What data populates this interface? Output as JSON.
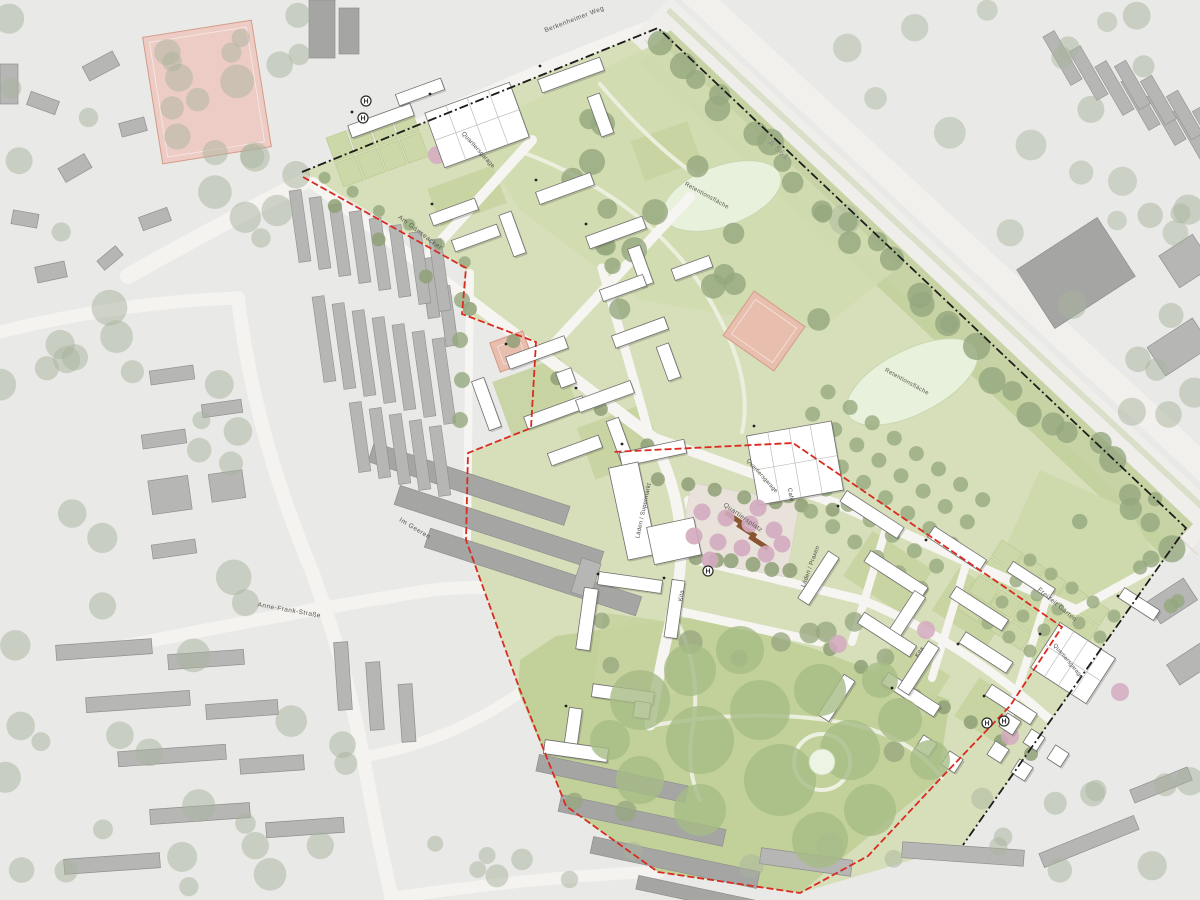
{
  "plan": {
    "labels": [
      {
        "id": "street-berkenheimer-weg",
        "text": "Berkenheimer Weg",
        "x": 575,
        "y": 21,
        "rot": -21,
        "size": 6.5,
        "color": "#55564f",
        "ls": 0.5
      },
      {
        "id": "highway-a561",
        "text": "A 561",
        "x": 777,
        "y": 152,
        "rot": 43,
        "size": 8,
        "color": "#8f9089",
        "ls": 1
      },
      {
        "id": "quartiersgarage-north",
        "text": "Quartiersgarage",
        "x": 477,
        "y": 151,
        "rot": 48,
        "size": 6,
        "color": "#4a4a44",
        "ls": 0.2
      },
      {
        "id": "retentionsflaeche-north",
        "text": "Retentionsfläche",
        "x": 706,
        "y": 197,
        "rot": 29,
        "size": 6,
        "color": "#5a5b50",
        "ls": 0.3
      },
      {
        "id": "retentionsflaeche-east",
        "text": "Retentionsfläche",
        "x": 906,
        "y": 383,
        "rot": 29,
        "size": 6,
        "color": "#5a5b50",
        "ls": 0.3
      },
      {
        "id": "street-am-gaenseacker",
        "text": "Am Gänseacker",
        "x": 419,
        "y": 234,
        "rot": 37,
        "size": 6.5,
        "color": "#55564f",
        "ls": 0.5
      },
      {
        "id": "street-im-geeren",
        "text": "Im Geeren",
        "x": 414,
        "y": 530,
        "rot": 31,
        "size": 6.5,
        "color": "#55564f",
        "ls": 0.5
      },
      {
        "id": "street-anne-frank-strasse",
        "text": "Anne-Frank-Straße",
        "x": 289,
        "y": 612,
        "rot": 10,
        "size": 6.5,
        "color": "#55564f",
        "ls": 0.5
      },
      {
        "id": "laeden-supermarkt",
        "text": "Läden / Supermarkt",
        "x": 645,
        "y": 511,
        "rot": -78,
        "size": 6,
        "color": "#4a4a44",
        "ls": 0.2
      },
      {
        "id": "quartiersplatz",
        "text": "Quartiersplatz",
        "x": 742,
        "y": 519,
        "rot": 35,
        "size": 6.5,
        "color": "#5a5b50",
        "ls": 0.4
      },
      {
        "id": "quartiersgarage-plaza",
        "text": "Quartiersgarage",
        "x": 761,
        "y": 477,
        "rot": 48,
        "size": 5.6,
        "color": "#4a4a44",
        "ls": 0.2
      },
      {
        "id": "cafe",
        "text": "Café",
        "x": 789,
        "y": 495,
        "rot": 80,
        "size": 6,
        "color": "#4a4a44",
        "ls": 0.2
      },
      {
        "id": "laeden-praxen",
        "text": "Läden / Praxen",
        "x": 812,
        "y": 567,
        "rot": -70,
        "size": 6,
        "color": "#4a4a44",
        "ls": 0.2
      },
      {
        "id": "kita-west",
        "text": "Kita",
        "x": 683,
        "y": 596,
        "rot": -80,
        "size": 6,
        "color": "#4a4a44",
        "ls": 0.2
      },
      {
        "id": "kita-east",
        "text": "Kita",
        "x": 921,
        "y": 653,
        "rot": -57,
        "size": 6,
        "color": "#4a4a44",
        "ls": 0.2
      },
      {
        "id": "freizeit-gaerten",
        "text": "Freizeit Gärten",
        "x": 1056,
        "y": 606,
        "rot": 40,
        "size": 6.5,
        "color": "#5a5b50",
        "ls": 0.4
      },
      {
        "id": "quartiersgarage-east",
        "text": "Quartiersgarage",
        "x": 1067,
        "y": 662,
        "rot": 50,
        "size": 5.6,
        "color": "#4a4a44",
        "ls": 0.2
      }
    ],
    "bus_stops": {
      "symbol": "H",
      "positions": [
        {
          "x": 366,
          "y": 101
        },
        {
          "x": 363,
          "y": 118
        },
        {
          "x": 708,
          "y": 571
        },
        {
          "x": 987,
          "y": 723
        },
        {
          "x": 1004,
          "y": 721
        }
      ]
    },
    "colors": {
      "background": "#e9e9e7",
      "road": "#f4f3f0",
      "site_green": "#d6dfba",
      "meadow_green": "#d0dbb0",
      "park_green": "#c2d09a",
      "canopy_green": "#a6bb86",
      "tree_olive": "#95a77e",
      "tree_light": "#b7c697",
      "tree_context": "#a9b39e",
      "plaza_tree_pink": "#d3aabf",
      "court_pink": "#e8beae",
      "court_pink_light": "#edccc5",
      "pond_mint": "#e7f1dc",
      "context_building": "#b6b6b5",
      "context_building_dark": "#a5a5a4",
      "site_building": "#ffffff",
      "plaza_paving": "#e8e2db",
      "deck_brown": "#8a5632",
      "boundary_red": "#d92b20",
      "boundary_black": "#1d1d1b"
    }
  }
}
